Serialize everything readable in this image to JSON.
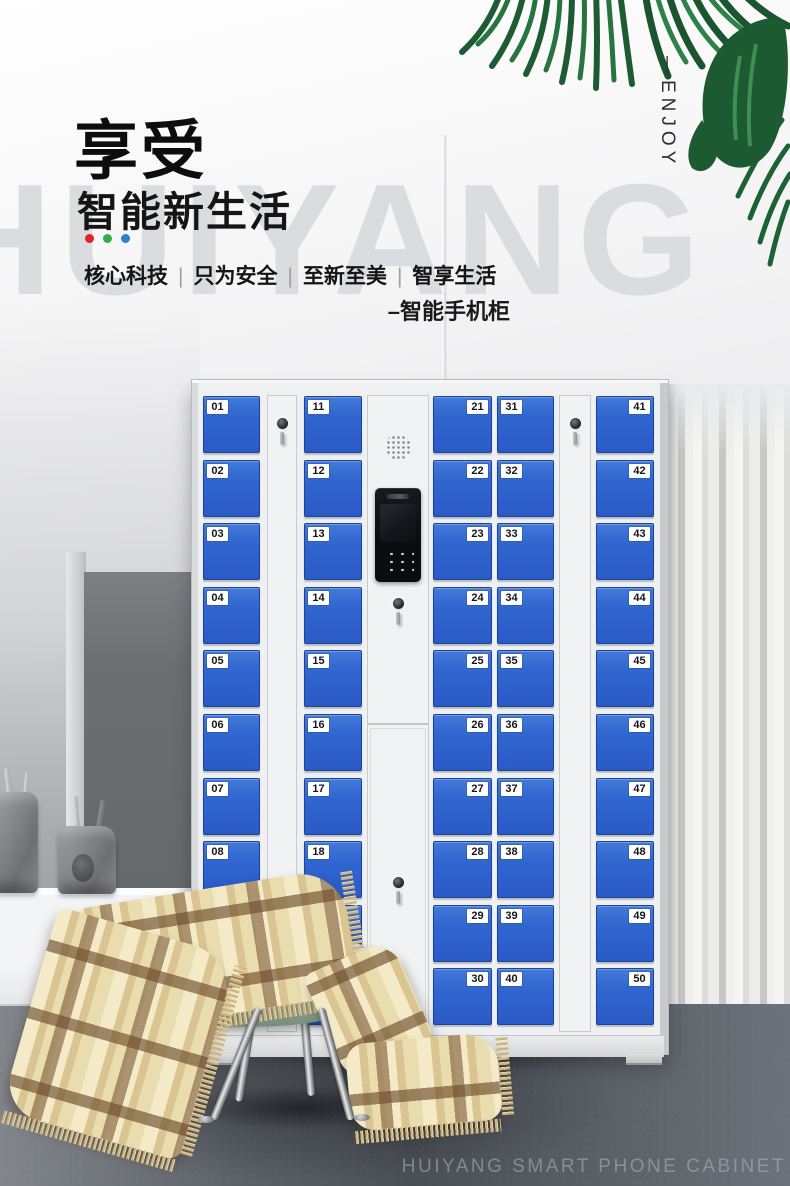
{
  "header": {
    "title": "享受",
    "subtitle": "智能新生活",
    "dots": [
      "#e02424",
      "#2fae4e",
      "#2e80cc"
    ],
    "tagline": [
      "核心科技",
      "只为安全",
      "至新至美",
      "智享生活"
    ],
    "tagline_separator": "|",
    "product_label": "–智能手机柜",
    "side_label": "—ENJOY",
    "watermark": "HUIYANG"
  },
  "locker": {
    "door_color": "#2f64d0",
    "frame_color": "#eef0f2",
    "panel_icons": {
      "speaker": "speaker-grille-icon",
      "camera": "camera-slit-icon",
      "screen": "intercom-screen",
      "keypad": "keypad-icon",
      "lock": "key-lock-icon"
    },
    "columns": [
      {
        "type": "doors",
        "tag_side": "left",
        "numbers": [
          "01",
          "02",
          "03",
          "04",
          "05",
          "06",
          "07",
          "08",
          "09",
          "10"
        ]
      },
      {
        "type": "side",
        "lock": "key-lock-icon"
      },
      {
        "type": "doors",
        "tag_side": "left",
        "numbers": [
          "11",
          "12",
          "13",
          "14",
          "15",
          "16",
          "17",
          "18",
          "19",
          "20"
        ]
      },
      {
        "type": "panel"
      },
      {
        "type": "doors",
        "tag_side": "right",
        "numbers": [
          "21",
          "22",
          "23",
          "24",
          "25",
          "26",
          "27",
          "28",
          "29",
          "30"
        ]
      },
      {
        "type": "doors",
        "tag_side": "left",
        "numbers": [
          "31",
          "32",
          "33",
          "34",
          "35",
          "36",
          "37",
          "38",
          "39",
          "40"
        ]
      },
      {
        "type": "side",
        "lock": "key-lock-icon"
      },
      {
        "type": "doors",
        "tag_side": "right",
        "numbers": [
          "41",
          "42",
          "43",
          "44",
          "45",
          "46",
          "47",
          "48",
          "49",
          "50"
        ]
      }
    ]
  },
  "footer": {
    "caption": "HUIYANG SMART PHONE CABINET"
  }
}
